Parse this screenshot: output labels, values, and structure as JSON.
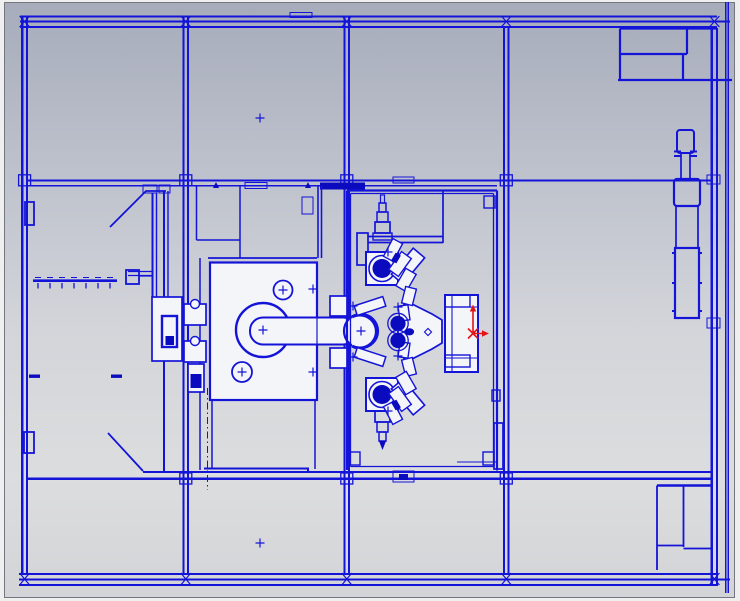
{
  "view": {
    "width": 740,
    "height": 601,
    "kind": "cad-viewport",
    "content": "machine-tool-top-view-wireframe"
  },
  "palette": {
    "line": "#1414d8",
    "line_soft": "#3a3ae0",
    "dark_fill": "#0a0abf",
    "white_fill": "#f4f5f8",
    "red": "#e51313",
    "bg_top": "#a7acbb",
    "bg_upper": "#bfc3cd",
    "bg_mid": "#d3d5da",
    "bg_low": "#dcddde",
    "bg_bottom": "#d3d4d7",
    "chrome": "#efefef",
    "border_dark": "#74777f",
    "border_light": "#c9ccd1"
  },
  "markers": {
    "cross_size": 4.5,
    "crosses": [
      {
        "x": 260,
        "y": 118
      },
      {
        "x": 260,
        "y": 543
      },
      {
        "x": 283,
        "y": 290
      },
      {
        "x": 242,
        "y": 372
      },
      {
        "x": 263,
        "y": 330
      },
      {
        "x": 313,
        "y": 289
      },
      {
        "x": 313,
        "y": 372
      },
      {
        "x": 361,
        "y": 331
      },
      {
        "x": 353,
        "y": 306
      },
      {
        "x": 353,
        "y": 357
      },
      {
        "x": 398,
        "y": 307
      },
      {
        "x": 398,
        "y": 356
      },
      {
        "x": 388,
        "y": 252
      },
      {
        "x": 388,
        "y": 411
      }
    ]
  },
  "triad": {
    "x": 473,
    "y": 333.5,
    "up_len": 29,
    "right_len": 14
  }
}
